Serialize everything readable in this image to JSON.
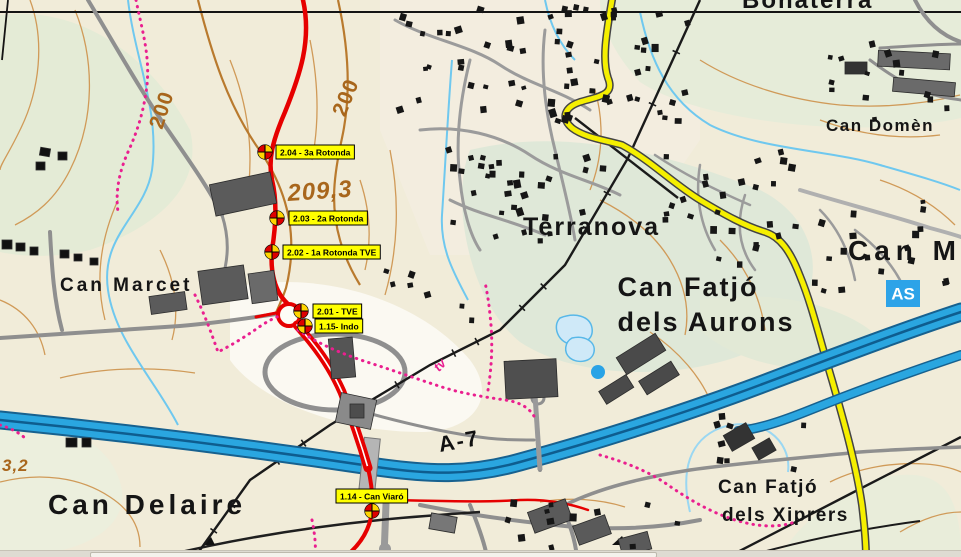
{
  "map": {
    "place_labels": [
      {
        "id": "label-bonaterra",
        "text": "Bonaterra",
        "x": 742,
        "y": 8,
        "size": 24,
        "font": "sans",
        "weight": "bold",
        "color": "#151515",
        "anchor": "start",
        "rotate": 0,
        "ls": 2
      },
      {
        "id": "label-can-domenec",
        "text": "Can Domèn",
        "x": 826,
        "y": 131,
        "size": 17,
        "font": "sans",
        "weight": "bold",
        "color": "#151515",
        "anchor": "start",
        "rotate": 0,
        "ls": 1.5
      },
      {
        "id": "label-can-m",
        "text": "Can M",
        "x": 848,
        "y": 260,
        "size": 28,
        "font": "serif",
        "weight": "bold",
        "color": "#151515",
        "anchor": "start",
        "rotate": 0,
        "ls": 6
      },
      {
        "id": "label-terranova",
        "text": "Terranova",
        "x": 523,
        "y": 235,
        "size": 25,
        "font": "sans",
        "weight": "bold",
        "color": "#151515",
        "anchor": "start",
        "rotate": 0,
        "ls": 2
      },
      {
        "id": "label-can-fatjo-aurons-1",
        "text": "Can Fatjó",
        "x": 688,
        "y": 296,
        "size": 27,
        "font": "sans",
        "weight": "bold",
        "color": "#151515",
        "anchor": "middle",
        "rotate": 0,
        "ls": 2
      },
      {
        "id": "label-can-fatjo-aurons-2",
        "text": "dels Aurons",
        "x": 706,
        "y": 331,
        "size": 27,
        "font": "sans",
        "weight": "bold",
        "color": "#151515",
        "anchor": "middle",
        "rotate": 0,
        "ls": 2
      },
      {
        "id": "label-can-marcet",
        "text": "Can Marcet",
        "x": 60,
        "y": 291,
        "size": 19,
        "font": "sans",
        "weight": "bold",
        "color": "#151515",
        "anchor": "start",
        "rotate": 0,
        "ls": 3
      },
      {
        "id": "label-can-delaire",
        "text": "Can Delaire",
        "x": 48,
        "y": 514,
        "size": 28,
        "font": "serif",
        "weight": "bold",
        "color": "#151515",
        "anchor": "start",
        "rotate": 0,
        "ls": 4
      },
      {
        "id": "label-can-fatjo-xiprers-1",
        "text": "Can Fatjó",
        "x": 718,
        "y": 493,
        "size": 19,
        "font": "sans",
        "weight": "bold",
        "color": "#151515",
        "anchor": "start",
        "rotate": 0,
        "ls": 1.5
      },
      {
        "id": "label-can-fatjo-xiprers-2",
        "text": "dels Xiprers",
        "x": 722,
        "y": 521,
        "size": 19,
        "font": "sans",
        "weight": "bold",
        "color": "#151515",
        "anchor": "start",
        "rotate": 0,
        "ls": 1.5
      }
    ],
    "road_labels": [
      {
        "id": "label-a7",
        "text": "A-7",
        "x": 440,
        "y": 452,
        "size": 22,
        "font": "sans",
        "weight": "bold",
        "color": "#111111",
        "anchor": "start",
        "rotate": -10,
        "ls": 2
      }
    ],
    "elevation_labels": [
      {
        "id": "contour-200-a",
        "text": "200",
        "x": 168,
        "y": 112,
        "size": 21,
        "font": "sans",
        "weight": "bold",
        "color": "#a8661c",
        "anchor": "middle",
        "rotate": -72,
        "ls": 1
      },
      {
        "id": "contour-200-b",
        "text": "200",
        "x": 352,
        "y": 100,
        "size": 21,
        "font": "sans",
        "weight": "bold",
        "color": "#a8661c",
        "anchor": "middle",
        "rotate": -68,
        "ls": 1
      },
      {
        "id": "spot-height-209",
        "text": "209,3",
        "x": 288,
        "y": 201,
        "size": 24,
        "font": "sans",
        "weight": "bold",
        "style": "italic",
        "color": "#a8661c",
        "anchor": "start",
        "rotate": -4,
        "ls": 1
      },
      {
        "id": "spot-height-3-2",
        "text": "3,2",
        "x": 2,
        "y": 471,
        "size": 17,
        "font": "sans",
        "weight": "bold",
        "style": "italic",
        "color": "#a8661c",
        "anchor": "start",
        "rotate": 0,
        "ls": 1
      }
    ],
    "trail_label": {
      "id": "label-trail-tv",
      "text": "tv",
      "x": 443,
      "y": 368,
      "size": 13,
      "font": "sans",
      "weight": "bold",
      "style": "italic",
      "color": "#e81f90",
      "anchor": "middle",
      "rotate": -48,
      "ls": 0
    },
    "motorway_badge": {
      "text": "AS",
      "bg": "#2da3e8",
      "fg": "#ffffff",
      "x": 886,
      "y": 280,
      "w": 34,
      "h": 27
    },
    "waypoints": [
      {
        "id": "wp-2-04",
        "label": "2.04 - 3a Rotonda",
        "marker": {
          "x": 265,
          "y": 152
        },
        "box": {
          "x": 276,
          "y": 145
        }
      },
      {
        "id": "wp-2-03",
        "label": "2.03 - 2a Rotonda",
        "marker": {
          "x": 277,
          "y": 218
        },
        "box": {
          "x": 289,
          "y": 211
        }
      },
      {
        "id": "wp-2-02",
        "label": "2.02 - 1a Rotonda TVE",
        "marker": {
          "x": 272,
          "y": 252
        },
        "box": {
          "x": 283,
          "y": 245
        }
      },
      {
        "id": "wp-2-01",
        "label": "2.01 - TVE",
        "marker": {
          "x": 301,
          "y": 311
        },
        "box": {
          "x": 313,
          "y": 304
        }
      },
      {
        "id": "wp-1-15",
        "label": "1.15- Indo",
        "marker": {
          "x": 305,
          "y": 326
        },
        "box": {
          "x": 315,
          "y": 319
        }
      },
      {
        "id": "wp-1-14",
        "label": "1.14 - Can Viaró",
        "marker": {
          "x": 372,
          "y": 511
        },
        "box": {
          "x": 336,
          "y": 489
        }
      }
    ],
    "colors": {
      "waypoint_label_bg": "#ffff00",
      "waypoint_marker_red": "#dd0000",
      "waypoint_marker_yellow": "#ffd400",
      "route_red": "#e60000",
      "motorway_blue": "#2aa6e0",
      "secondary_road_yellow": "#f5ef00",
      "trail_pink": "#ea1f8f",
      "contour_brown": "#cf9a55",
      "stream_blue": "#6fc8ef"
    }
  }
}
